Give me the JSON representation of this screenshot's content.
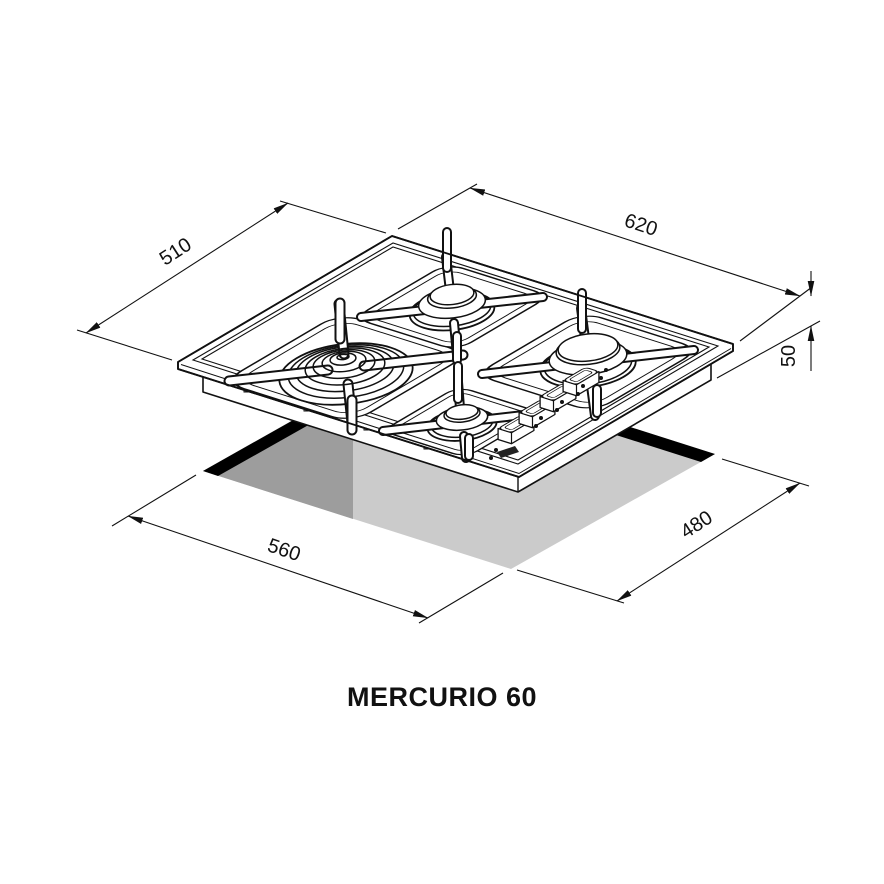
{
  "title": "MERCURIO 60",
  "dimensions": {
    "hob_width": "620",
    "hob_depth": "510",
    "build_in_height": "50",
    "cutout_width": "560",
    "cutout_depth": "480"
  },
  "colors": {
    "line": "#111111",
    "cutout_edge_band": "#000000",
    "cutout_dark": "#9d9d9d",
    "cutout_light": "#cbcbcb"
  }
}
